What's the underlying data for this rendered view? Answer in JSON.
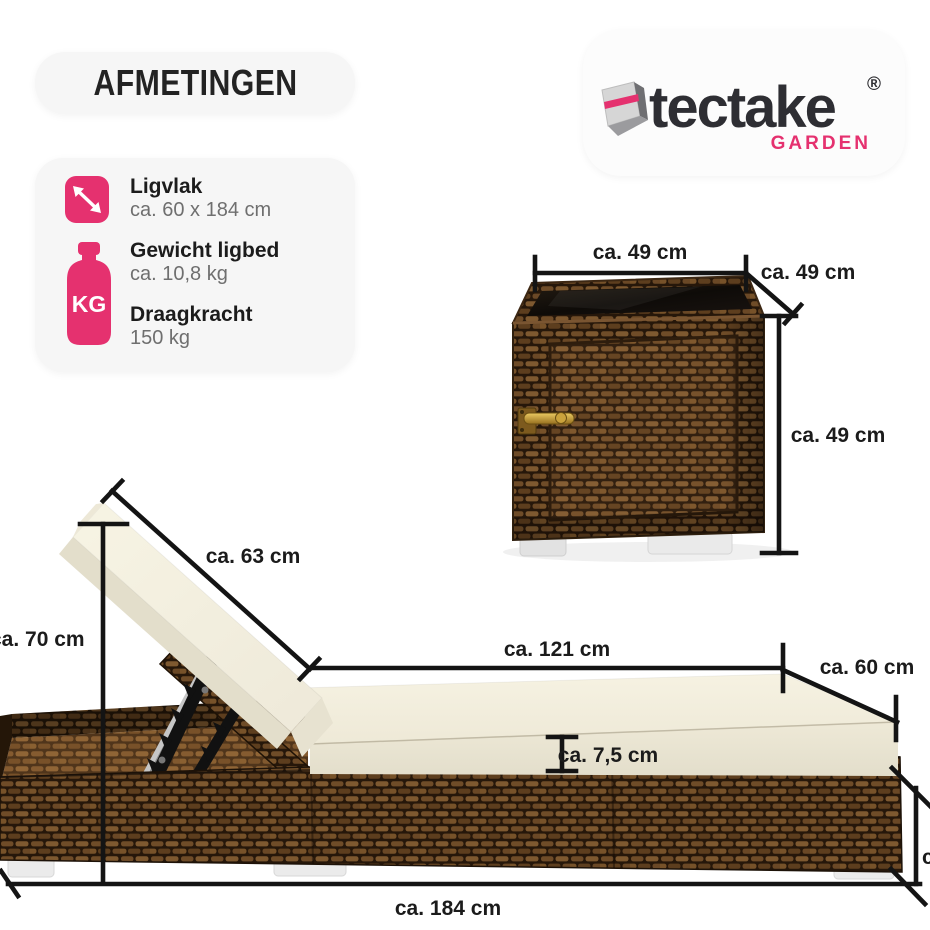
{
  "page": {
    "title_badge": "AFMETINGEN"
  },
  "brand": {
    "wordmark": "tectake",
    "registered": "®",
    "sub_brand": "GARDEN",
    "pink": "#e5316f",
    "dark": "#2e2e33"
  },
  "specs": {
    "items": [
      {
        "icon": "diagonal-resize-arrow",
        "label": "Ligvlak",
        "value": "ca. 60 x 184 cm"
      },
      {
        "icon": "weight",
        "label": "Gewicht ligbed",
        "value": "ca. 10,8 kg"
      },
      {
        "icon": "weight",
        "label": "Draagkracht",
        "value": "150 kg"
      }
    ],
    "weight_icon_text": "KG"
  },
  "dimensions": {
    "side_table": {
      "width": "ca. 49 cm",
      "depth": "ca. 49 cm",
      "height": "ca. 49 cm"
    },
    "lounger": {
      "backrest_length": "ca. 63 cm",
      "backrest_height": "ca. 70 cm",
      "flat_section_length": "ca. 121 cm",
      "width": "ca. 60 cm",
      "cushion_thickness": "ca. 7,5 cm",
      "total_length": "ca. 184 cm",
      "right_edge_label_fragment": "c"
    }
  },
  "colors": {
    "dimension_line": "#141414",
    "label_text": "#1b1b1b",
    "pill_background": "#f6f6f6",
    "cushion_cream": "#f3efdf",
    "wicker_brown": "#5d3e1e",
    "accent_pink": "#e5316f"
  }
}
